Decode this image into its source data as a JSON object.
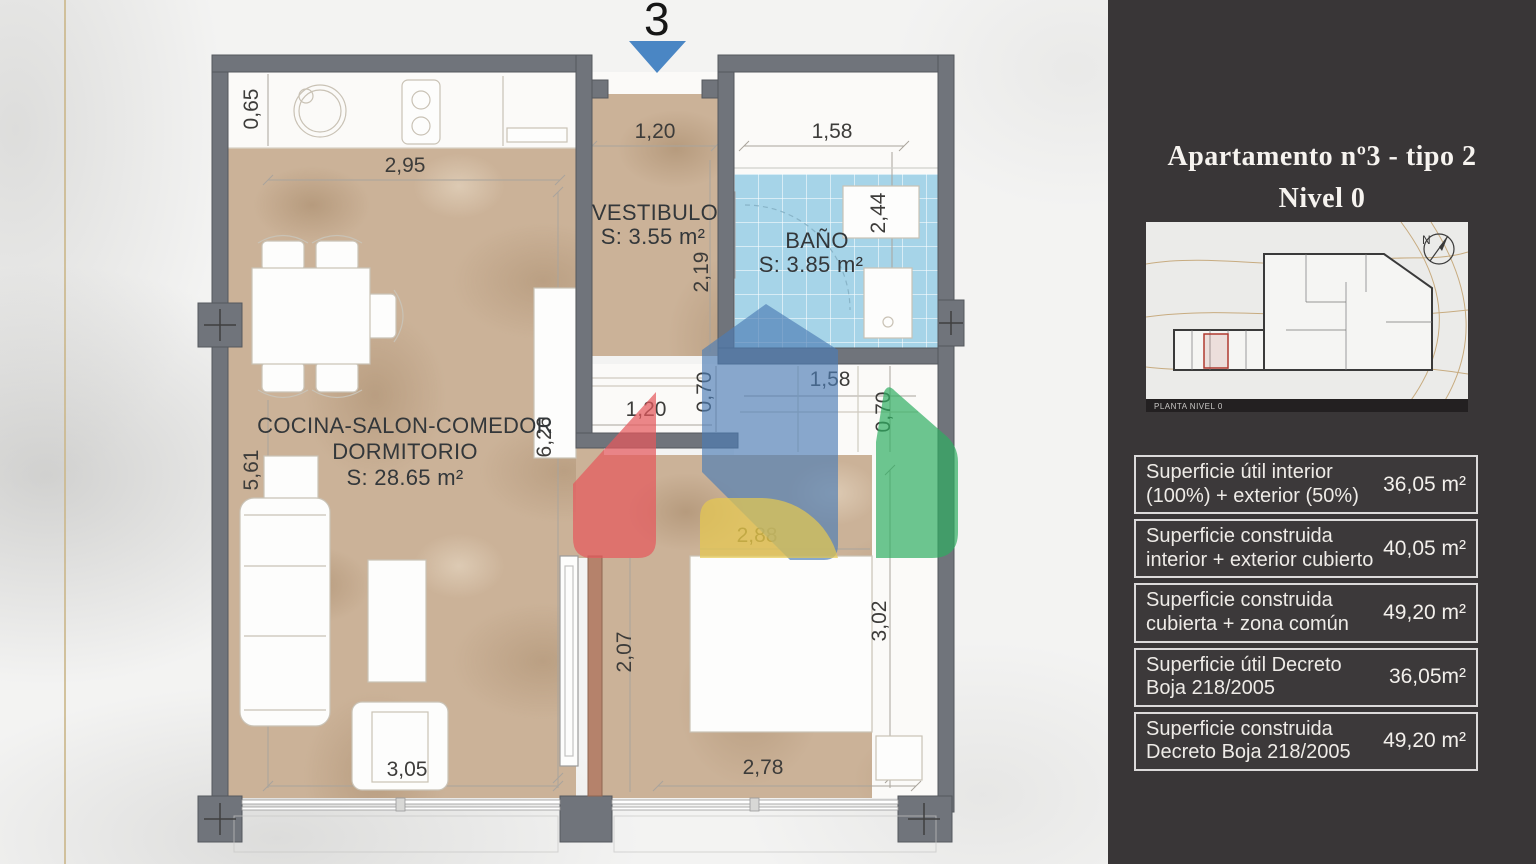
{
  "plan": {
    "unit_number": "3",
    "rooms": {
      "vestibulo": {
        "name": "VESTIBULO",
        "area": "S: 3.55 m²"
      },
      "bano": {
        "name": "BAÑO",
        "area": "S: 3.85 m²"
      },
      "living": {
        "name_line1": "COCINA-SALON-COMEDOR",
        "name_line2": "DORMITORIO",
        "area": "S: 28.65 m²"
      }
    },
    "dims": {
      "kitchen_depth": "0,65",
      "kitchen_width": "2,95",
      "entry_width": "1,20",
      "bath_width": "1,58",
      "bath_depth": "2,44",
      "vestibule_depth": "2,19",
      "living_side_right": "6,26",
      "living_side_left": "5,61",
      "entry_closet_width": "1,20",
      "entry_closet_depth": "0,70",
      "bath_closet_width": "1,58",
      "bath_closet_depth": "0,70",
      "bed_width": "2,88",
      "bedroom_door_span": "2,07",
      "bedroom_depth": "3,02",
      "living_width": "3,05",
      "bedroom_width": "2,78"
    }
  },
  "sidebar": {
    "title_line1": "Apartamento nº3 - tipo 2",
    "title_line2": "Nivel 0",
    "thumbnail": {
      "caption": "PLANTA NIVEL 0",
      "compass_label": "N"
    },
    "surface_table": {
      "rows": [
        {
          "label": "Superficie útil interior (100%) + exterior (50%)",
          "value": "36,05 m²"
        },
        {
          "label": "Superficie construida interior + exterior cubierto",
          "value": "40,05 m²"
        },
        {
          "label": "Superficie construida cubierta + zona común",
          "value": "49,20 m²"
        },
        {
          "label": "Superficie útil Decreto Boja 218/2005",
          "value": "36,05m²"
        },
        {
          "label": "Superficie construida Decreto Boja 218/2005",
          "value": "49,20 m²"
        }
      ]
    }
  },
  "colors": {
    "sidebar_bg": "#393637",
    "wall_gray": "#70747b",
    "floor_tan": "#cbb298",
    "bath_tile_blue": "#a6d4e8",
    "divider_wall_brown": "#b5826b",
    "arrow_red": "#e4595d",
    "arrow_blue": "#4c7db4",
    "arrow_green": "#2fae63",
    "arrow_yellow": "#e7c94f",
    "entry_marker_blue": "#4a86c4",
    "gold_rule": "#cbb98e"
  }
}
